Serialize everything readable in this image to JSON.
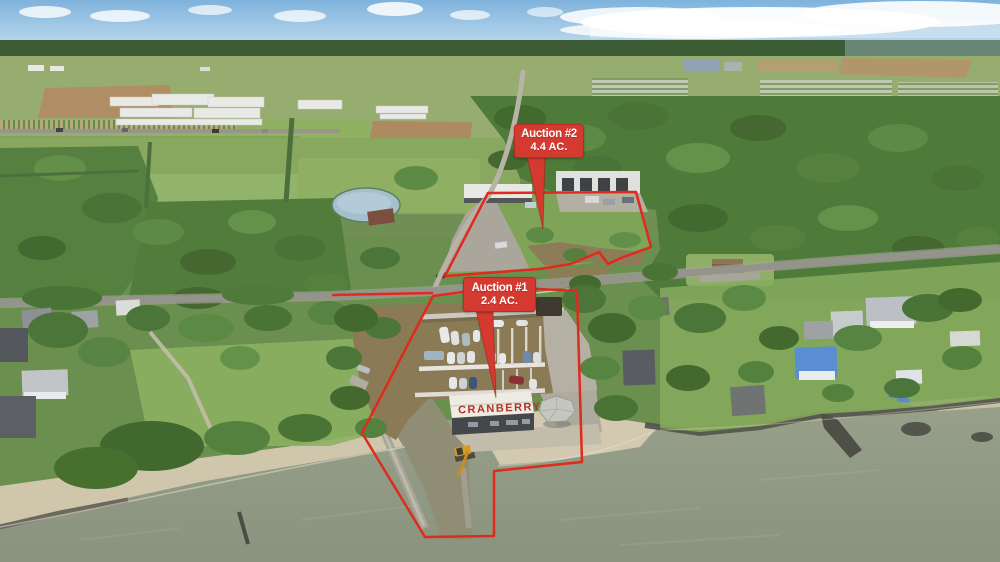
{
  "annotations": {
    "auction2": {
      "title": "Auction #2",
      "acreage": "4.4 AC."
    },
    "auction1": {
      "title": "Auction #1",
      "acreage": "2.4 AC."
    }
  },
  "landmarks": {
    "marina_building_sign": "CRANBERRY"
  },
  "colors": {
    "annotation-red": "#e02a1e",
    "label-red": "#d43a30",
    "label-text": "#ffffff",
    "sign-red": "#b23228",
    "sky-blue": "#7fb3dc",
    "lake-grey-green": "#8f9a84",
    "marina-water-brown": "#8a7a55",
    "beach-sand": "#cfc6ac",
    "foliage-green": "#55803e"
  }
}
